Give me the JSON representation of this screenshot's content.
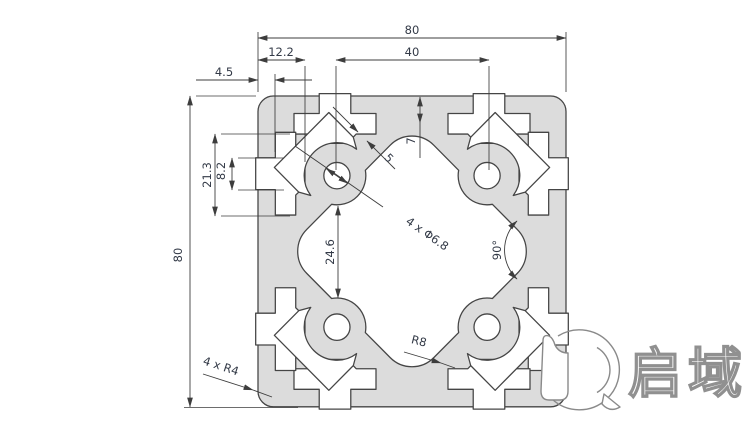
{
  "drawing": {
    "title": "80x80 aluminium extrusion profile cross-section",
    "dimensions": {
      "overall_width": "80",
      "overall_height": "80",
      "slot_spacing": "40",
      "slot_depth": "12.2",
      "lip_thickness": "4.5",
      "slot_cavity_width": "21.3",
      "slot_opening": "8.2",
      "center_gap": "24.6",
      "face_wall": "7",
      "web_thickness": "5",
      "holes": "4 x Φ6.8",
      "web_angle": "90°",
      "cavity_radius": "R8",
      "corner_radius": "4 x R4"
    },
    "colors": {
      "profile_fill": "#dcdcdc",
      "line": "#454545",
      "dim_text": "#333a47"
    },
    "logo": {
      "brand": "启域"
    }
  }
}
